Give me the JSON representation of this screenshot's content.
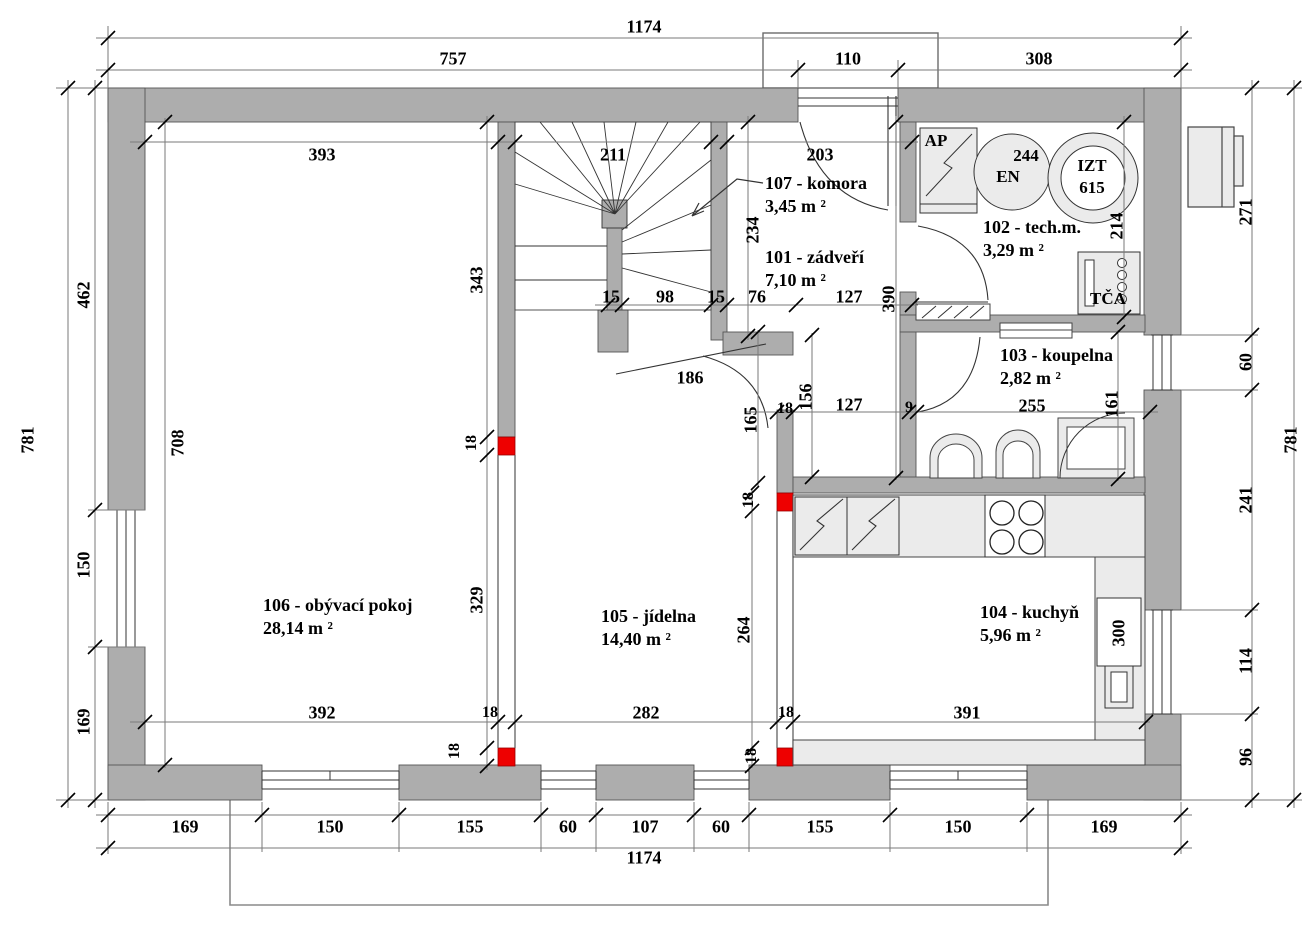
{
  "rooms": [
    {
      "id": "101",
      "label": "101 - zádveří",
      "area": "7,10 m ²"
    },
    {
      "id": "102",
      "label": "102 - tech.m.",
      "area": "3,29 m ²"
    },
    {
      "id": "103",
      "label": "103 - koupelna",
      "area": "2,82 m ²"
    },
    {
      "id": "104",
      "label": "104 - kuchyň",
      "area": "5,96 m ²"
    },
    {
      "id": "105",
      "label": "105 - jídelna",
      "area": "14,40 m ²"
    },
    {
      "id": "106",
      "label": "106 - obývací pokoj",
      "area": "28,14 m ²"
    },
    {
      "id": "107",
      "label": "107 - komora",
      "area": "3,45 m ²"
    }
  ],
  "equipment": {
    "ap": "AP",
    "en": "EN",
    "en_value": "244",
    "izt": "IZT",
    "izt_value": "615",
    "tca": "TČA"
  },
  "dims": {
    "top": {
      "total": "1174",
      "segments": [
        "757",
        "110",
        "308"
      ],
      "inner": [
        "393",
        "211",
        "203"
      ]
    },
    "bottom": {
      "total": "1174",
      "segments": [
        "169",
        "150",
        "155",
        "60",
        "107",
        "60",
        "155",
        "150",
        "169"
      ],
      "inner": [
        "392",
        "282",
        "391"
      ]
    },
    "left": {
      "total": "781",
      "segments": [
        "462",
        "150",
        "169"
      ],
      "inner": [
        "708",
        "343",
        "329"
      ]
    },
    "right": {
      "total": "781",
      "segments": [
        "271",
        "60",
        "241",
        "114",
        "96"
      ]
    },
    "stair": [
      "15",
      "98",
      "15"
    ],
    "entry": [
      "76",
      "127",
      "390",
      "234",
      "186"
    ],
    "hall": [
      "165",
      "156",
      "127",
      "9"
    ],
    "bath": [
      "255",
      "161"
    ],
    "tech_depth": "214",
    "dining_depth": "264",
    "sink_unit": "300",
    "wall_thickness": "18"
  },
  "colors": {
    "wall": "#adadad",
    "column": "#ee0000",
    "fixture": "#ebebeb"
  }
}
